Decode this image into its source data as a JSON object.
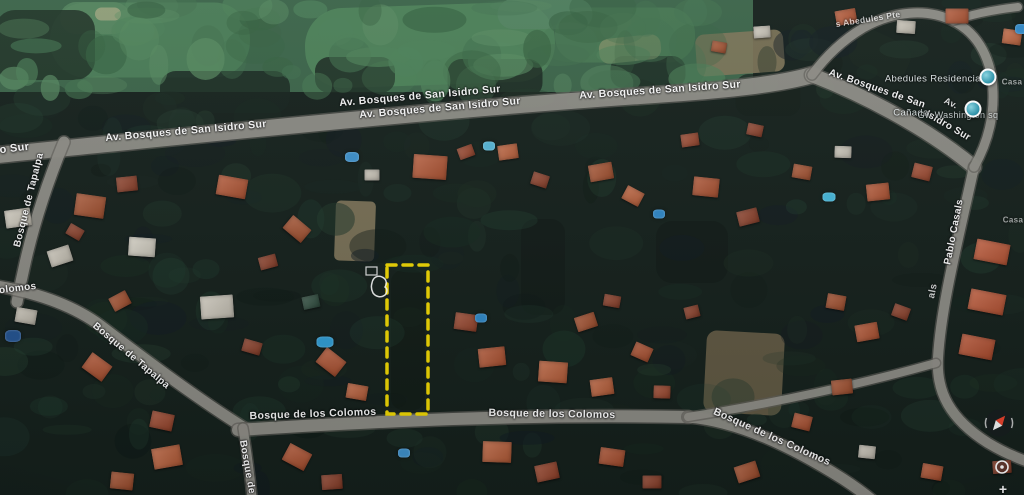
{
  "map": {
    "colors": {
      "base": "#141f1a",
      "golf": "#3a6347",
      "road": "#8f8e87",
      "road_casing": "#5f5e58",
      "label": "#ffffff",
      "highlight": "#eed500",
      "marker": "#2e96ad"
    }
  },
  "roads": [
    {
      "name": "av-bosques-main",
      "path": "M -12,156 C 180,137 420,111 640,96 C 700,92 770,87 812,75",
      "width": 16
    },
    {
      "name": "av-bosques-curve",
      "path": "M 812,75 C 866,96 928,129 974,167",
      "width": 14
    },
    {
      "name": "pablo-casals",
      "path": "M 974,167 C 958,240 941,306 938,358 C 936,392 950,419 988,443 C 1003,452 1016,458 1032,463",
      "width": 10
    },
    {
      "name": "abedules-loop",
      "path": "M 812,75 C 826,56 843,40 863,28 C 893,11 927,8 953,21 C 980,34 992,62 993,92 C 994,120 987,144 974,167",
      "width": 9
    },
    {
      "name": "abedules-north",
      "path": "M 953,21 C 972,14 992,10 1018,7",
      "width": 8
    },
    {
      "name": "tapalpa-north",
      "path": "M 64,142 C 48,181 33,226 24,268 C 21,281 19,291 17,302",
      "width": 11
    },
    {
      "name": "tapalpa-diagonal",
      "path": "M -10,285 C 30,291 70,303 101,326 C 151,364 201,401 246,429",
      "width": 11
    },
    {
      "name": "colomos-main",
      "path": "M 238,430 C 380,421 520,414 688,417",
      "width": 12
    },
    {
      "name": "colomos-southeast",
      "path": "M 688,417 C 737,421 789,445 843,479 C 863,492 877,503 889,516",
      "width": 11
    },
    {
      "name": "colomos-east-connector",
      "path": "M 688,417 C 770,404 862,384 936,363",
      "width": 8
    },
    {
      "name": "bosque-south",
      "path": "M 243,428 C 247,452 250,474 253,508",
      "width": 9
    }
  ],
  "patches": [
    [
      358,
      44,
      790,
      96,
      0,
      "#3a6347",
      1,
      0
    ],
    [
      150,
      40,
      200,
      75,
      0,
      "#4a7c55",
      0.9,
      36
    ],
    [
      430,
      45,
      250,
      80,
      -2,
      "#4e8258",
      0.85,
      38
    ],
    [
      625,
      35,
      140,
      55,
      0,
      "#477751",
      0.85,
      26
    ],
    [
      95,
      18,
      70,
      32,
      0,
      "#55855e",
      0.75,
      16
    ],
    [
      545,
      14,
      95,
      30,
      0,
      "#538360",
      0.75,
      16
    ],
    [
      108,
      14,
      26,
      13,
      0,
      "#9aa27c",
      0.85,
      8
    ],
    [
      45,
      45,
      100,
      70,
      0,
      "#1d2f23",
      0.85,
      20
    ],
    [
      225,
      92,
      130,
      42,
      0,
      "#15221b",
      0.8,
      16
    ],
    [
      355,
      75,
      80,
      36,
      0,
      "#16231c",
      0.8,
      14
    ],
    [
      495,
      78,
      95,
      38,
      0,
      "#15211a",
      0.8,
      14
    ],
    [
      648,
      72,
      75,
      32,
      0,
      "#14201a",
      0.75,
      13
    ],
    [
      768,
      95,
      65,
      42,
      0,
      "#121d17",
      0.7,
      13
    ],
    [
      355,
      231,
      40,
      60,
      2,
      "#81765a",
      0.9,
      5
    ],
    [
      740,
      53,
      88,
      42,
      -4,
      "#7d7356",
      0.9,
      9
    ],
    [
      744,
      373,
      78,
      82,
      3,
      "#6b6048",
      0.85,
      10
    ],
    [
      630,
      49,
      62,
      25,
      -6,
      "#8a9468",
      0.65,
      10
    ],
    [
      543,
      267,
      44,
      96,
      0,
      "#101915",
      0.75,
      14
    ],
    [
      692,
      252,
      72,
      62,
      0,
      "#0f1814",
      0.65,
      16
    ],
    [
      408,
      340,
      34,
      140,
      0,
      "#0e1712",
      0.55,
      12
    ],
    [
      880,
      55,
      60,
      40,
      25,
      "#18241c",
      0.6,
      14
    ]
  ],
  "buildings": [
    [
      90,
      206,
      30,
      22,
      8,
      "#a8502c"
    ],
    [
      127,
      184,
      21,
      15,
      -6,
      "#8f3e26"
    ],
    [
      232,
      187,
      30,
      20,
      10,
      "#b5532f"
    ],
    [
      297,
      229,
      24,
      17,
      40,
      "#a8502c"
    ],
    [
      268,
      262,
      18,
      13,
      -15,
      "#8f3e26"
    ],
    [
      430,
      167,
      34,
      24,
      4,
      "#b5532f"
    ],
    [
      466,
      152,
      16,
      12,
      -20,
      "#9c4429"
    ],
    [
      508,
      152,
      20,
      15,
      -8,
      "#c06038"
    ],
    [
      540,
      180,
      17,
      13,
      18,
      "#8f3e26"
    ],
    [
      601,
      172,
      24,
      17,
      -10,
      "#a8502c"
    ],
    [
      633,
      196,
      19,
      15,
      28,
      "#c06038"
    ],
    [
      706,
      187,
      26,
      19,
      6,
      "#b0502d"
    ],
    [
      748,
      217,
      21,
      15,
      -14,
      "#8f3e26"
    ],
    [
      802,
      172,
      19,
      14,
      10,
      "#a8502c"
    ],
    [
      843,
      152,
      17,
      12,
      2,
      "#cfc9bb"
    ],
    [
      878,
      192,
      23,
      17,
      -6,
      "#b5532f"
    ],
    [
      922,
      172,
      19,
      15,
      14,
      "#a0462a"
    ],
    [
      60,
      256,
      23,
      17,
      -18,
      "#cfc9bb"
    ],
    [
      142,
      247,
      27,
      19,
      4,
      "#d9d4c6"
    ],
    [
      26,
      316,
      21,
      15,
      10,
      "#c9c3b5"
    ],
    [
      120,
      301,
      19,
      15,
      -28,
      "#a8502c"
    ],
    [
      97,
      367,
      25,
      19,
      36,
      "#b5532f"
    ],
    [
      162,
      421,
      23,
      17,
      12,
      "#a0462a"
    ],
    [
      217,
      307,
      33,
      23,
      -4,
      "#d2ccbe"
    ],
    [
      252,
      347,
      19,
      13,
      16,
      "#8f3e26"
    ],
    [
      331,
      362,
      25,
      19,
      38,
      "#b5532f"
    ],
    [
      357,
      392,
      21,
      15,
      10,
      "#c06038"
    ],
    [
      311,
      302,
      17,
      13,
      -12,
      "#2e4d3d"
    ],
    [
      466,
      322,
      23,
      17,
      8,
      "#9c4429"
    ],
    [
      492,
      357,
      27,
      19,
      -6,
      "#b5532f"
    ],
    [
      553,
      372,
      29,
      21,
      4,
      "#c06038"
    ],
    [
      586,
      322,
      21,
      15,
      -18,
      "#a8502c"
    ],
    [
      612,
      301,
      17,
      12,
      10,
      "#8f3e26"
    ],
    [
      642,
      352,
      19,
      15,
      24,
      "#b0502d"
    ],
    [
      602,
      387,
      23,
      17,
      -8,
      "#c06038"
    ],
    [
      662,
      392,
      17,
      13,
      2,
      "#a0462a"
    ],
    [
      692,
      312,
      15,
      12,
      -14,
      "#8f3e26"
    ],
    [
      836,
      302,
      19,
      15,
      10,
      "#a8502c"
    ],
    [
      867,
      332,
      23,
      17,
      -10,
      "#b5532f"
    ],
    [
      901,
      312,
      17,
      13,
      20,
      "#8f3e26"
    ],
    [
      992,
      252,
      34,
      21,
      11,
      "#c05532"
    ],
    [
      987,
      302,
      36,
      21,
      11,
      "#c05532"
    ],
    [
      977,
      347,
      34,
      21,
      11,
      "#b84e2c"
    ],
    [
      842,
      387,
      21,
      15,
      -6,
      "#a8502c"
    ],
    [
      802,
      422,
      19,
      15,
      14,
      "#b0502d"
    ],
    [
      167,
      457,
      29,
      21,
      -10,
      "#c06038"
    ],
    [
      122,
      481,
      23,
      17,
      6,
      "#a8502c"
    ],
    [
      297,
      457,
      25,
      19,
      28,
      "#b5532f"
    ],
    [
      332,
      482,
      21,
      15,
      -4,
      "#8f3e26"
    ],
    [
      497,
      452,
      29,
      21,
      2,
      "#c06038"
    ],
    [
      547,
      472,
      23,
      17,
      -12,
      "#9c4429"
    ],
    [
      612,
      457,
      25,
      17,
      8,
      "#b0502d"
    ],
    [
      652,
      482,
      19,
      13,
      0,
      "#8f3e26"
    ],
    [
      747,
      472,
      23,
      17,
      -18,
      "#a8502c"
    ],
    [
      932,
      472,
      21,
      15,
      10,
      "#b5532f"
    ],
    [
      1002,
      467,
      19,
      13,
      -4,
      "#8f3e26"
    ],
    [
      867,
      452,
      17,
      13,
      6,
      "#cfc9bb"
    ],
    [
      846,
      17,
      21,
      15,
      -10,
      "#b5532f"
    ],
    [
      906,
      27,
      19,
      13,
      4,
      "#c9c3b5"
    ],
    [
      957,
      16,
      23,
      15,
      0,
      "#b0502d"
    ],
    [
      1012,
      37,
      19,
      15,
      8,
      "#c06038"
    ],
    [
      762,
      32,
      17,
      12,
      -4,
      "#cfc9bb"
    ],
    [
      719,
      47,
      15,
      11,
      10,
      "#a8502c"
    ],
    [
      18,
      218,
      26,
      18,
      -8,
      "#d2ccbe"
    ],
    [
      75,
      232,
      16,
      12,
      30,
      "#8f3e26"
    ],
    [
      372,
      175,
      15,
      11,
      0,
      "#cfc9bb"
    ],
    [
      690,
      140,
      18,
      13,
      -8,
      "#9c4429"
    ],
    [
      755,
      130,
      16,
      12,
      12,
      "#8f3e26"
    ]
  ],
  "pools": [
    [
      352,
      157,
      14,
      10,
      "#3d8fc9"
    ],
    [
      489,
      146,
      12,
      9,
      "#55b4d4"
    ],
    [
      659,
      214,
      12,
      9,
      "#2f86c4"
    ],
    [
      829,
      197,
      13,
      9,
      "#45b6d8"
    ],
    [
      325,
      342,
      17,
      11,
      "#2f9ad0"
    ],
    [
      481,
      318,
      12,
      9,
      "#2f86c4"
    ],
    [
      404,
      453,
      12,
      9,
      "#3d8fc9"
    ],
    [
      1021,
      29,
      12,
      10,
      "#2f86c4"
    ],
    [
      13,
      336,
      16,
      12,
      "#22518d"
    ]
  ],
  "street_labels": [
    {
      "text": "Isidro Sur",
      "x": 2,
      "y": 150,
      "rot": -7,
      "size": 11,
      "op": 0.95
    },
    {
      "text": "Av. Bosques de San Isidro Sur",
      "x": 186,
      "y": 131,
      "rot": -5,
      "size": 10.5,
      "op": 0.95
    },
    {
      "text": "Av. Bosques de San Isidro Sur",
      "x": 420,
      "y": 96,
      "rot": -5,
      "size": 10.5,
      "op": 0.95
    },
    {
      "text": "Av. Bosques de San Isidro Sur",
      "x": 440,
      "y": 108,
      "rot": -5,
      "size": 10.5,
      "op": 0.95
    },
    {
      "text": "Av. Bosques de San Isidro Sur",
      "x": 660,
      "y": 90,
      "rot": -4,
      "size": 10.5,
      "op": 0.95
    },
    {
      "text": "Av. Bosques de San",
      "x": 877,
      "y": 89,
      "rot": 19,
      "size": 10,
      "op": 0.95
    },
    {
      "text": "Isidro Sur",
      "x": 948,
      "y": 126,
      "rot": 30,
      "size": 10,
      "op": 0.95
    },
    {
      "text": "s Abedules Pte",
      "x": 868,
      "y": 19,
      "rot": -9,
      "size": 8.5,
      "op": 0.7
    },
    {
      "text": "Av.",
      "x": 951,
      "y": 103,
      "rot": 26,
      "size": 9,
      "op": 0.85
    },
    {
      "text": "Pablo Casals",
      "x": 954,
      "y": 232,
      "rot": -79,
      "size": 10,
      "op": 0.95
    },
    {
      "text": "Bosque de Tapalpa",
      "x": 29,
      "y": 200,
      "rot": -76,
      "size": 10,
      "op": 0.95
    },
    {
      "text": "Colomos",
      "x": 14,
      "y": 289,
      "rot": -7,
      "size": 10,
      "op": 0.95
    },
    {
      "text": "Bosque de Tapalpa",
      "x": 131,
      "y": 356,
      "rot": 40,
      "size": 10,
      "op": 0.95
    },
    {
      "text": "Bosque de los Colomos",
      "x": 313,
      "y": 414,
      "rot": -2,
      "size": 10.5,
      "op": 0.95
    },
    {
      "text": "Bosque de los Colomos",
      "x": 552,
      "y": 414,
      "rot": 1,
      "size": 10.5,
      "op": 0.95
    },
    {
      "text": "Bosque de los Colomos",
      "x": 772,
      "y": 437,
      "rot": 24,
      "size": 10.5,
      "op": 0.95
    },
    {
      "text": "Bosque de",
      "x": 247,
      "y": 467,
      "rot": 80,
      "size": 10,
      "op": 0.95
    },
    {
      "text": "als",
      "x": 933,
      "y": 291,
      "rot": -79,
      "size": 10,
      "op": 0.8
    },
    {
      "text": "Casa",
      "x": 1013,
      "y": 220,
      "rot": 0,
      "size": 8,
      "op": 0.6
    },
    {
      "text": "Casa",
      "x": 1012,
      "y": 82,
      "rot": 0,
      "size": 8,
      "op": 0.6
    }
  ],
  "poi_labels": [
    {
      "text": "Abedules Residencial",
      "x": 934,
      "y": 79,
      "size": 9.5,
      "op": 0.92
    },
    {
      "text": "Cañada",
      "x": 911,
      "y": 113,
      "size": 9.5,
      "op": 0.9
    },
    {
      "text": "Gw Washington sq",
      "x": 958,
      "y": 115,
      "size": 9,
      "op": 0.8
    }
  ],
  "markers": [
    {
      "x": 988,
      "y": 77
    },
    {
      "x": 973,
      "y": 109
    }
  ],
  "lot_outline": {
    "x": 387,
    "y": 265,
    "w": 41,
    "h": 149,
    "color": "#eed500",
    "dash": "9 7",
    "stroke": 3.5
  },
  "trace": {
    "blob_path": "M372,283 c1,-6 6,-8 10,-6 c5,2 5,7 3,10 c3,2 2,6 0,8 c-4,3 -9,2 -12,-2 c-2,-4 -2,-7 -1,-10 z",
    "rect": {
      "x": 366,
      "y": 267,
      "w": 11,
      "h": 8
    },
    "color": "#ffffff"
  },
  "controls": {
    "compass": {
      "x": 999,
      "y": 423,
      "r": 13.5,
      "needle_rot": 40,
      "north_color": "#e8402a",
      "south_color": "#f2f2f2"
    },
    "target": {
      "x": 1002,
      "y": 467,
      "r": 6
    },
    "zoom_plus": {
      "label": "+"
    }
  }
}
